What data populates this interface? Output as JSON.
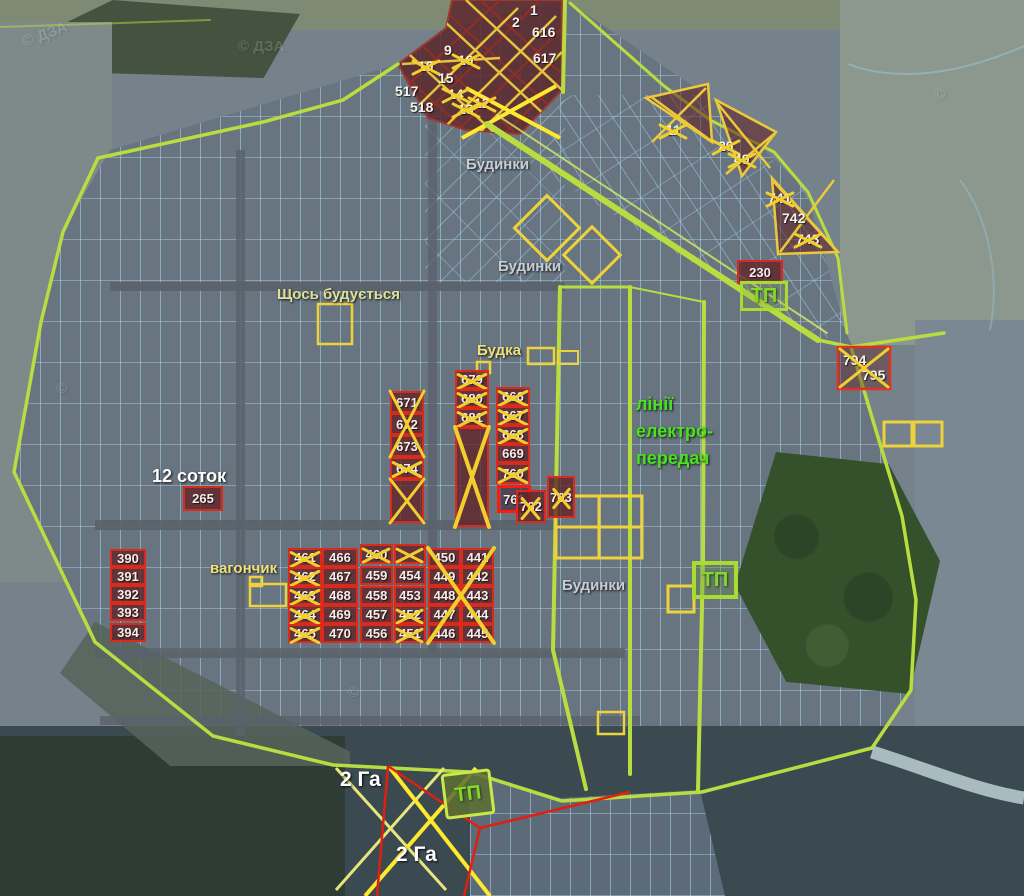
{
  "colors": {
    "lime": "#b9dd40",
    "gold": "#f2cf2d",
    "red": "#d92a1c",
    "maroon": "#5c2b31",
    "grid_blue": "#a5d7f0",
    "green_text": "#49e21f"
  },
  "labels": [
    {
      "text": "Будинки",
      "x": 466,
      "y": 156,
      "cls": "gray"
    },
    {
      "text": "Будинки",
      "x": 498,
      "y": 258,
      "cls": "gray"
    },
    {
      "text": "Будинки",
      "x": 562,
      "y": 577,
      "cls": "gray"
    },
    {
      "text": "Щось будується",
      "x": 277,
      "y": 286,
      "cls": "paleyellow"
    },
    {
      "text": "Будка",
      "x": 477,
      "y": 342,
      "cls": "yellow"
    },
    {
      "text": "вагончик",
      "x": 210,
      "y": 560,
      "cls": "yellow"
    },
    {
      "text": "12 соток",
      "x": 152,
      "y": 466,
      "cls": "white"
    },
    {
      "text": "2 Га",
      "x": 340,
      "y": 768,
      "cls": "white-lg"
    },
    {
      "text": "2 Га",
      "x": 396,
      "y": 843,
      "cls": "white-lg"
    },
    {
      "text": "лінії",
      "x": 636,
      "y": 394,
      "cls": "green"
    },
    {
      "text": "електро-",
      "x": 636,
      "y": 421,
      "cls": "green"
    },
    {
      "text": "передач",
      "x": 636,
      "y": 448,
      "cls": "green"
    }
  ],
  "watermarks": [
    {
      "text": "© ДЗА",
      "x": 22,
      "y": 26,
      "rot": -20
    },
    {
      "text": "© ДЗА",
      "x": 238,
      "y": 38,
      "rot": 0
    },
    {
      "text": "©",
      "x": 56,
      "y": 380,
      "rot": 0
    },
    {
      "text": "©",
      "x": 348,
      "y": 684,
      "rot": 0
    },
    {
      "text": "©",
      "x": 934,
      "y": 86,
      "rot": 0
    }
  ],
  "plots": [
    {
      "n": "1",
      "x": 530,
      "y": 2,
      "cls": "plain"
    },
    {
      "n": "2",
      "x": 512,
      "y": 14,
      "cls": "plain"
    },
    {
      "n": "616",
      "x": 532,
      "y": 24,
      "cls": "plain"
    },
    {
      "n": "617",
      "x": 533,
      "y": 50,
      "cls": "plain"
    },
    {
      "n": "9",
      "x": 444,
      "y": 42,
      "cls": "plain"
    },
    {
      "n": "10",
      "x": 418,
      "y": 58,
      "cls": "plain",
      "crossed": true
    },
    {
      "n": "10",
      "x": 458,
      "y": 52,
      "cls": "plain",
      "crossed": true
    },
    {
      "n": "15",
      "x": 438,
      "y": 70,
      "cls": "plain"
    },
    {
      "n": "14",
      "x": 448,
      "y": 86,
      "cls": "plain",
      "crossed": true
    },
    {
      "n": "13",
      "x": 458,
      "y": 101,
      "cls": "plain",
      "crossed": true
    },
    {
      "n": "12",
      "x": 474,
      "y": 95,
      "cls": "plain",
      "crossed": true
    },
    {
      "n": "517",
      "x": 395,
      "y": 83,
      "cls": "plain"
    },
    {
      "n": "518",
      "x": 410,
      "y": 99,
      "cls": "plain"
    },
    {
      "n": "11",
      "x": 666,
      "y": 122,
      "cls": "plain",
      "crossed": true
    },
    {
      "n": "20",
      "x": 718,
      "y": 138,
      "cls": "plain",
      "crossed": true
    },
    {
      "n": "49",
      "x": 734,
      "y": 151,
      "cls": "plain",
      "crossed": true
    },
    {
      "n": "741",
      "x": 768,
      "y": 190,
      "cls": "plain",
      "crossed": true
    },
    {
      "n": "742",
      "x": 782,
      "y": 210,
      "cls": "plain"
    },
    {
      "n": "743",
      "x": 796,
      "y": 231,
      "cls": "plain",
      "crossed": true
    },
    {
      "n": "230",
      "x": 737,
      "y": 260,
      "w": 46,
      "h": 24,
      "cls": "box"
    },
    {
      "n": "794",
      "x": 843,
      "y": 352,
      "cls": "plain"
    },
    {
      "n": "795",
      "x": 862,
      "y": 367,
      "cls": "plain"
    },
    {
      "n": "671",
      "x": 390,
      "y": 391,
      "w": 34,
      "h": 22,
      "cls": "box"
    },
    {
      "n": "672",
      "x": 390,
      "y": 413,
      "w": 34,
      "h": 22,
      "cls": "box"
    },
    {
      "n": "673",
      "x": 390,
      "y": 435,
      "w": 34,
      "h": 22,
      "cls": "box"
    },
    {
      "n": "674",
      "x": 390,
      "y": 457,
      "w": 34,
      "h": 22,
      "cls": "box",
      "crossed": true
    },
    {
      "n": "",
      "x": 390,
      "y": 479,
      "w": 34,
      "h": 44,
      "cls": "box"
    },
    {
      "n": "679",
      "x": 455,
      "y": 370,
      "w": 34,
      "h": 19,
      "cls": "box",
      "crossed": true
    },
    {
      "n": "680",
      "x": 455,
      "y": 389,
      "w": 34,
      "h": 19,
      "cls": "box",
      "crossed": true
    },
    {
      "n": "681",
      "x": 455,
      "y": 408,
      "w": 34,
      "h": 19,
      "cls": "box",
      "crossed": true
    },
    {
      "n": "",
      "x": 455,
      "y": 427,
      "w": 34,
      "h": 100,
      "cls": "box"
    },
    {
      "n": "666",
      "x": 496,
      "y": 387,
      "w": 34,
      "h": 19,
      "cls": "box",
      "crossed": true
    },
    {
      "n": "667",
      "x": 496,
      "y": 406,
      "w": 34,
      "h": 19,
      "cls": "box",
      "crossed": true
    },
    {
      "n": "668",
      "x": 496,
      "y": 425,
      "w": 34,
      "h": 19,
      "cls": "box",
      "crossed": true
    },
    {
      "n": "669",
      "x": 496,
      "y": 444,
      "w": 34,
      "h": 19,
      "cls": "box"
    },
    {
      "n": "760",
      "x": 496,
      "y": 463,
      "w": 34,
      "h": 21,
      "cls": "box",
      "crossed": true
    },
    {
      "n": "761",
      "x": 497,
      "y": 485,
      "w": 34,
      "h": 28,
      "cls": "box bright"
    },
    {
      "n": "762",
      "x": 516,
      "y": 490,
      "w": 30,
      "h": 33,
      "cls": "box",
      "crossed": true,
      "steep": true
    },
    {
      "n": "763",
      "x": 547,
      "y": 476,
      "w": 28,
      "h": 42,
      "cls": "box",
      "crossed": true,
      "steep": true
    },
    {
      "n": "265",
      "x": 183,
      "y": 486,
      "w": 40,
      "h": 25,
      "cls": "box"
    },
    {
      "n": "390",
      "x": 110,
      "y": 549,
      "w": 36,
      "h": 18,
      "cls": "box"
    },
    {
      "n": "391",
      "x": 110,
      "y": 567,
      "w": 36,
      "h": 18,
      "cls": "box"
    },
    {
      "n": "392",
      "x": 110,
      "y": 585,
      "w": 36,
      "h": 18,
      "cls": "box"
    },
    {
      "n": "393",
      "x": 110,
      "y": 603,
      "w": 36,
      "h": 18,
      "cls": "box"
    },
    {
      "n": "394",
      "x": 110,
      "y": 623,
      "w": 36,
      "h": 19,
      "cls": "box"
    },
    {
      "n": "461",
      "x": 288,
      "y": 548,
      "w": 34,
      "h": 19,
      "cls": "box",
      "crossed": true
    },
    {
      "n": "462",
      "x": 288,
      "y": 567,
      "w": 34,
      "h": 19,
      "cls": "box",
      "crossed": true
    },
    {
      "n": "463",
      "x": 288,
      "y": 586,
      "w": 34,
      "h": 19,
      "cls": "box",
      "crossed": true
    },
    {
      "n": "464",
      "x": 288,
      "y": 605,
      "w": 34,
      "h": 19,
      "cls": "box",
      "crossed": true
    },
    {
      "n": "465",
      "x": 288,
      "y": 624,
      "w": 34,
      "h": 19,
      "cls": "box",
      "crossed": true
    },
    {
      "n": "466",
      "x": 322,
      "y": 548,
      "w": 36,
      "h": 19,
      "cls": "box"
    },
    {
      "n": "467",
      "x": 322,
      "y": 567,
      "w": 36,
      "h": 19,
      "cls": "box"
    },
    {
      "n": "468",
      "x": 322,
      "y": 586,
      "w": 36,
      "h": 19,
      "cls": "box"
    },
    {
      "n": "469",
      "x": 322,
      "y": 605,
      "w": 36,
      "h": 19,
      "cls": "box"
    },
    {
      "n": "470",
      "x": 322,
      "y": 624,
      "w": 36,
      "h": 19,
      "cls": "box"
    },
    {
      "n": "460",
      "x": 360,
      "y": 544,
      "w": 33,
      "h": 20,
      "cls": "box",
      "crossed": true
    },
    {
      "n": "459",
      "x": 360,
      "y": 566,
      "w": 33,
      "h": 19,
      "cls": "box"
    },
    {
      "n": "458",
      "x": 360,
      "y": 586,
      "w": 33,
      "h": 19,
      "cls": "box"
    },
    {
      "n": "457",
      "x": 360,
      "y": 605,
      "w": 33,
      "h": 19,
      "cls": "box"
    },
    {
      "n": "456",
      "x": 360,
      "y": 624,
      "w": 33,
      "h": 19,
      "cls": "box"
    },
    {
      "n": "",
      "x": 394,
      "y": 544,
      "w": 32,
      "h": 20,
      "cls": "box",
      "crossed": true
    },
    {
      "n": "454",
      "x": 394,
      "y": 566,
      "w": 32,
      "h": 19,
      "cls": "box"
    },
    {
      "n": "453",
      "x": 394,
      "y": 586,
      "w": 32,
      "h": 19,
      "cls": "box"
    },
    {
      "n": "452",
      "x": 394,
      "y": 605,
      "w": 32,
      "h": 19,
      "cls": "box",
      "crossed": true
    },
    {
      "n": "451",
      "x": 394,
      "y": 624,
      "w": 32,
      "h": 19,
      "cls": "box",
      "crossed": true
    },
    {
      "n": "450",
      "x": 428,
      "y": 548,
      "w": 33,
      "h": 19,
      "cls": "box"
    },
    {
      "n": "449",
      "x": 428,
      "y": 567,
      "w": 33,
      "h": 19,
      "cls": "box"
    },
    {
      "n": "448",
      "x": 428,
      "y": 586,
      "w": 33,
      "h": 19,
      "cls": "box"
    },
    {
      "n": "447",
      "x": 428,
      "y": 605,
      "w": 33,
      "h": 19,
      "cls": "box"
    },
    {
      "n": "446",
      "x": 428,
      "y": 624,
      "w": 33,
      "h": 19,
      "cls": "box"
    },
    {
      "n": "441",
      "x": 461,
      "y": 548,
      "w": 33,
      "h": 19,
      "cls": "box"
    },
    {
      "n": "442",
      "x": 461,
      "y": 567,
      "w": 33,
      "h": 19,
      "cls": "box"
    },
    {
      "n": "443",
      "x": 461,
      "y": 586,
      "w": 33,
      "h": 19,
      "cls": "box"
    },
    {
      "n": "444",
      "x": 461,
      "y": 605,
      "w": 33,
      "h": 19,
      "cls": "box"
    },
    {
      "n": "445",
      "x": 461,
      "y": 624,
      "w": 33,
      "h": 19,
      "cls": "box"
    }
  ],
  "tp_boxes": [
    {
      "label": "ТП",
      "x": 740,
      "y": 281,
      "w": 48,
      "h": 30,
      "variant": ""
    },
    {
      "label": "ТП",
      "x": 692,
      "y": 561,
      "w": 46,
      "h": 38,
      "variant": "outline2"
    },
    {
      "label": "ТП",
      "x": 443,
      "y": 771,
      "w": 50,
      "h": 46,
      "variant": "filled",
      "rot": -7
    }
  ],
  "big_crosses": [
    {
      "x": 428,
      "y": 548,
      "w": 66,
      "h": 95,
      "t": 4
    },
    {
      "x": 390,
      "y": 391,
      "w": 34,
      "h": 66,
      "t": 3
    },
    {
      "x": 390,
      "y": 479,
      "w": 34,
      "h": 44,
      "t": 3
    },
    {
      "x": 455,
      "y": 427,
      "w": 34,
      "h": 100,
      "t": 4
    },
    {
      "x": 840,
      "y": 349,
      "w": 48,
      "h": 38,
      "t": 3
    }
  ]
}
